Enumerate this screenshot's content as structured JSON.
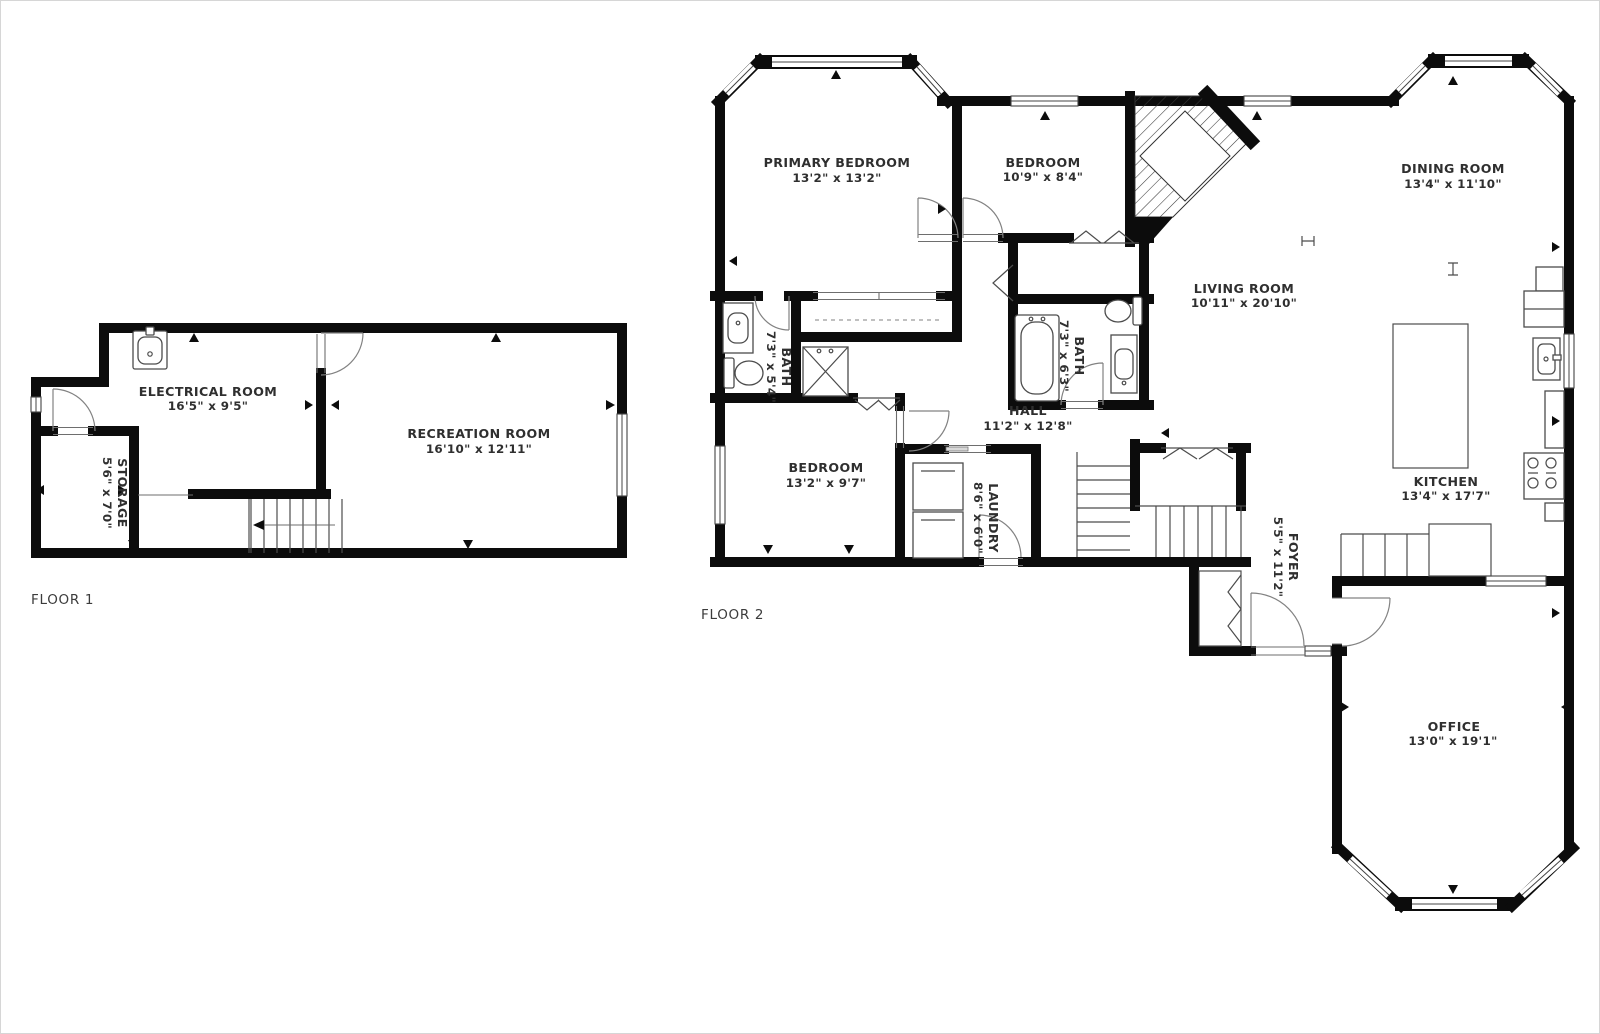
{
  "colors": {
    "bg": "#ffffff",
    "frame": "#d6d6d6",
    "wall": "#0c0c0c",
    "text": "#2f2f2f"
  },
  "floor1": {
    "label": "FLOOR 1",
    "rooms": {
      "electrical": {
        "name": "ELECTRICAL ROOM",
        "dims": "16'5\" x 9'5\""
      },
      "recreation": {
        "name": "RECREATION ROOM",
        "dims": "16'10\" x 12'11\""
      },
      "storage": {
        "name": "STORAGE",
        "dims": "5'6\" x 7'0\""
      }
    }
  },
  "floor2": {
    "label": "FLOOR 2",
    "rooms": {
      "primary": {
        "name": "PRIMARY BEDROOM",
        "dims": "13'2\" x 13'2\""
      },
      "bedroom2": {
        "name": "BEDROOM",
        "dims": "10'9\" x 8'4\""
      },
      "dining": {
        "name": "DINING ROOM",
        "dims": "13'4\" x 11'10\""
      },
      "living": {
        "name": "LIVING ROOM",
        "dims": "10'11\" x 20'10\""
      },
      "bath1": {
        "name": "BATH",
        "dims": "7'3\" x 5'4\""
      },
      "bath2": {
        "name": "BATH",
        "dims": "7'3\" x 6'3\""
      },
      "hall": {
        "name": "HALL",
        "dims": "11'2\" x 12'8\""
      },
      "bedroom3": {
        "name": "BEDROOM",
        "dims": "13'2\" x 9'7\""
      },
      "laundry": {
        "name": "LAUNDRY",
        "dims": "8'6\" x 6'0\""
      },
      "kitchen": {
        "name": "KITCHEN",
        "dims": "13'4\" x 17'7\""
      },
      "foyer": {
        "name": "FOYER",
        "dims": "5'5\" x 11'2\""
      },
      "office": {
        "name": "OFFICE",
        "dims": "13'0\" x 19'1\""
      }
    }
  }
}
